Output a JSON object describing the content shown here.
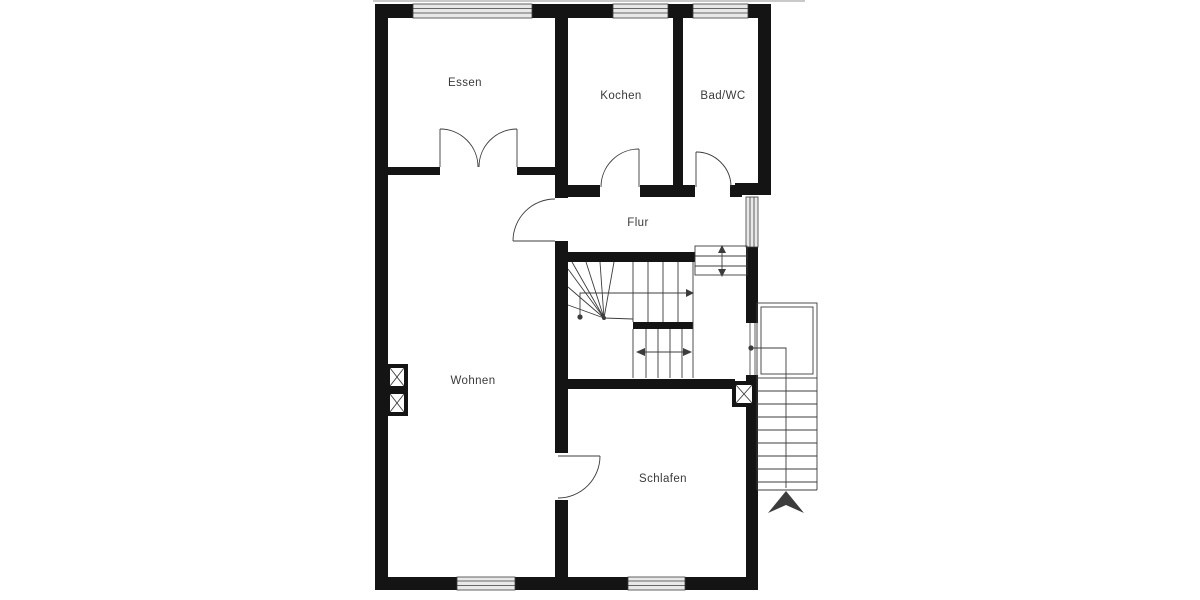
{
  "floorplan": {
    "rooms": [
      {
        "id": "essen",
        "label": "Essen"
      },
      {
        "id": "kochen",
        "label": "Kochen"
      },
      {
        "id": "bad-wc",
        "label": "Bad/WC"
      },
      {
        "id": "flur",
        "label": "Flur"
      },
      {
        "id": "wohnen",
        "label": "Wohnen"
      },
      {
        "id": "schlafen",
        "label": "Schlafen"
      }
    ],
    "colors": {
      "wall": "#141414",
      "line": "#3c3c3c",
      "window_fill": "#e8e8e8",
      "label": "#3a3a3a",
      "background": "#ffffff"
    }
  }
}
